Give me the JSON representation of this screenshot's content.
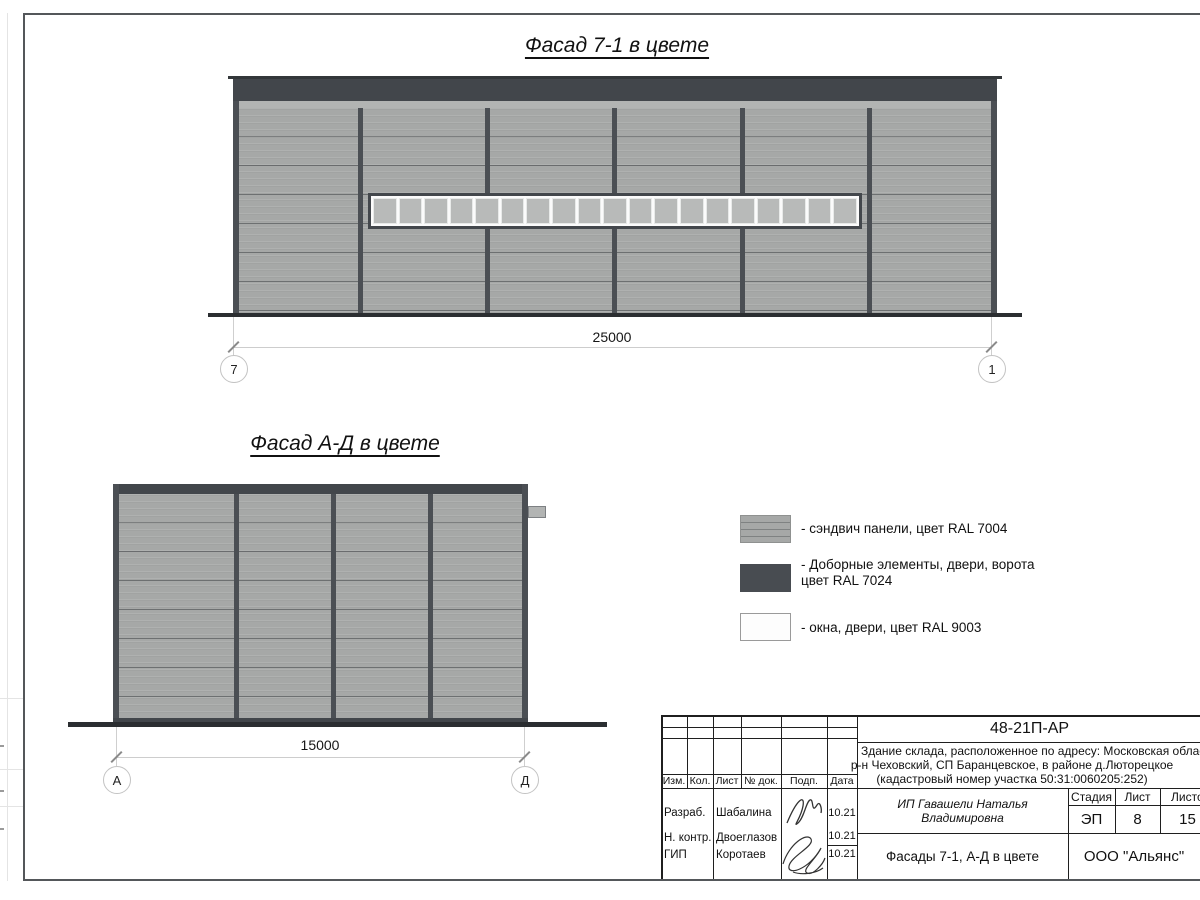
{
  "facade1": {
    "title": "Фасад 7-1 в цвете",
    "dimension": "25000",
    "axis_left": "7",
    "axis_right": "1",
    "window_pane_count": 19
  },
  "facade2": {
    "title": "Фасад А-Д в цвете",
    "dimension": "15000",
    "axis_left": "А",
    "axis_right": "Д"
  },
  "legend": {
    "items": [
      {
        "lines": [
          "- сэндвич панели, цвет RAL 7004"
        ]
      },
      {
        "lines": [
          "- Доборные элементы, двери, ворота",
          "цвет RAL 7024"
        ]
      },
      {
        "lines": [
          "- окна, двери, цвет RAL 9003"
        ]
      }
    ]
  },
  "title_block": {
    "doc_number": "48-21П-АР",
    "project_line1": "Здание склада, расположенное по адресу: Московская область",
    "project_line2": "р-н Чеховский, СП Баранцевское, в районе д.Люторецкое",
    "project_line3": "(кадастровый номер участка 50:31:0060205:252)",
    "client": "ИП Гавашели Наталья Владимировна",
    "sheet_title": "Фасады 7-1, А-Д в цвете",
    "company": "ООО \"Альянс\"",
    "stage_label": "Стадия",
    "stage_value": "ЭП",
    "sheet_label": "Лист",
    "sheet_value": "8",
    "sheets_label": "Листов",
    "sheets_value": "15",
    "header_cols": {
      "izm": "Изм.",
      "kol": "Кол.",
      "list": "Лист",
      "doc": "№ док.",
      "podp": "Подп.",
      "data": "Дата"
    },
    "rows": [
      {
        "role": "Разраб.",
        "name": "Шабалина",
        "date": "10.21"
      },
      {
        "role": "Н. контр.",
        "name": "Двоеглазов",
        "date": "10.21"
      },
      {
        "role": "ГИП",
        "name": "Коротаев",
        "date": "10.21"
      }
    ]
  },
  "colors": {
    "panel_ral7004": "#a6a8a7",
    "dark_ral7024": "#42464b",
    "white_ral9003": "#fdfdfd"
  }
}
